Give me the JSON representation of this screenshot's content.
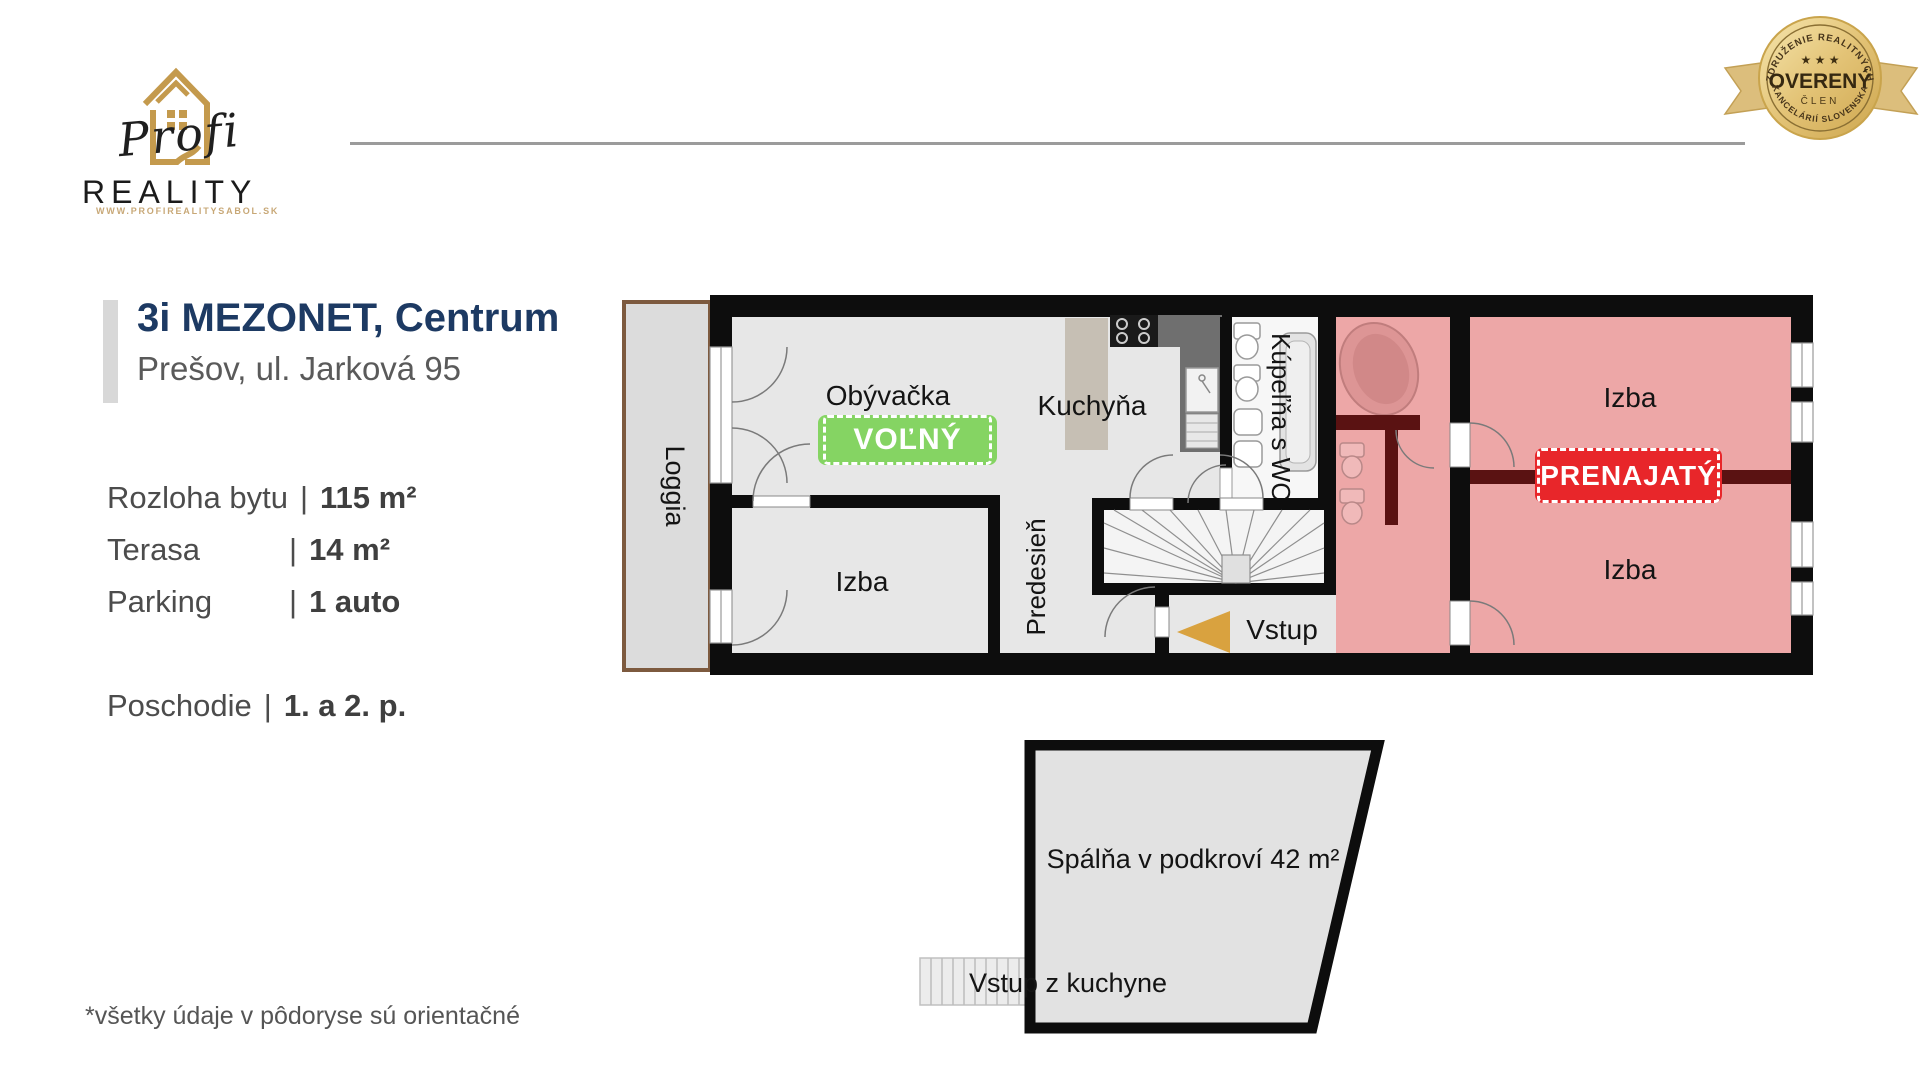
{
  "brand": {
    "profi": "Profi",
    "reality": "REALITY",
    "url": "WWW.PROFIREALITYSABOL.SK"
  },
  "medal": {
    "arc_top": "ZDRUŽENIE REALITNÝCH",
    "stars": "★ ★ ★",
    "main": "OVERENÝ",
    "sub": "ČLEN",
    "arc_bottom": "KANCELÁRIÍ SLOVENSKA"
  },
  "listing": {
    "title": "3i MEZONET, Centrum",
    "address": "Prešov, ul. Jarková 95",
    "sep": "|",
    "details": [
      {
        "label": "Rozloha bytu",
        "value": "115 m²"
      },
      {
        "label": "Terasa",
        "value": "14 m²"
      },
      {
        "label": "Parking",
        "value": "1 auto"
      }
    ],
    "floor": {
      "label": "Poschodie",
      "value": "1. a 2. p."
    }
  },
  "plan": {
    "rooms": {
      "loggia": "Loggia",
      "living": "Obývačka",
      "kitchen": "Kuchyňa",
      "bathroom": "Kúpeľňa s WC",
      "room_left": "Izba",
      "hall": "Predesieň",
      "room_top_right": "Izba",
      "room_bottom_right": "Izba"
    },
    "status_free": "VOĽNÝ",
    "status_rented": "PRENAJATÝ",
    "entry": "Vstup"
  },
  "attic": {
    "room": "Spálňa v podkroví 42 m²",
    "entry": "Vstup z kuchyne"
  },
  "footnote": "*všetky údaje v pôdoryse sú orientačné",
  "colors": {
    "gold": "#c49a4d",
    "navy": "#1d3a63",
    "green": "#85d463",
    "red": "#e8262a",
    "pink": "#eda7a7",
    "dark_red": "#5a1212",
    "wall": "#0d0d0d",
    "floor": "#e7e7e7"
  }
}
